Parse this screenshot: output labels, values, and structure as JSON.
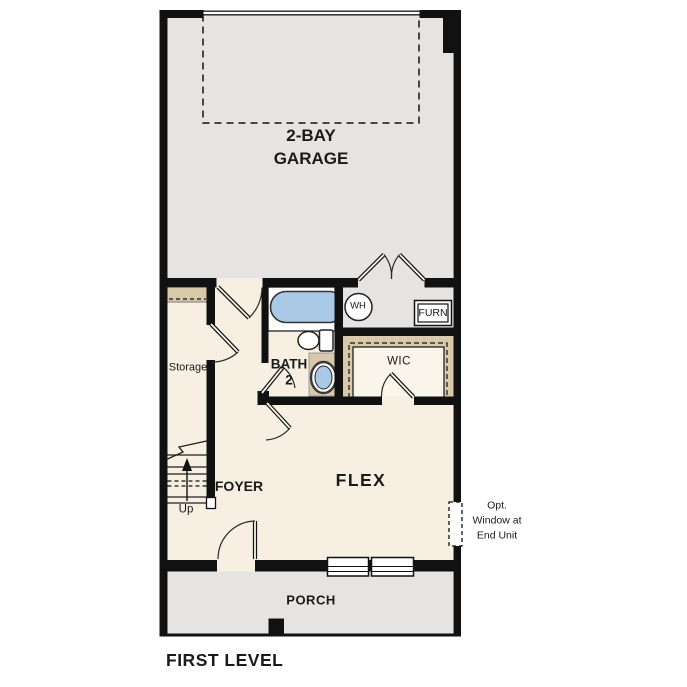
{
  "title": {
    "text": "FIRST LEVEL"
  },
  "rooms": {
    "garage": {
      "line1": "2-BAY",
      "line2": "GARAGE"
    },
    "storage": {
      "label": "Storage"
    },
    "bath2": {
      "line1": "BATH",
      "line2": "2"
    },
    "wic": {
      "label": "WIC"
    },
    "foyer": {
      "label": "FOYER"
    },
    "flex": {
      "label": "FLEX"
    },
    "porch": {
      "label": "PORCH"
    }
  },
  "fixtures": {
    "water_heater": {
      "label": "WH"
    },
    "furnace": {
      "label": "FURN"
    }
  },
  "stairs": {
    "direction_label": "Up"
  },
  "notes": {
    "opt_window": {
      "line1": "Opt.",
      "line2": "Window at",
      "line3": "End Unit"
    }
  },
  "colors": {
    "wall": "#111111",
    "cream": "#f7f0e2",
    "gray": "#e6e4e2",
    "tan": "#d8c9ab",
    "blue": "#aac9e7",
    "ink": "#1a1a1a"
  }
}
